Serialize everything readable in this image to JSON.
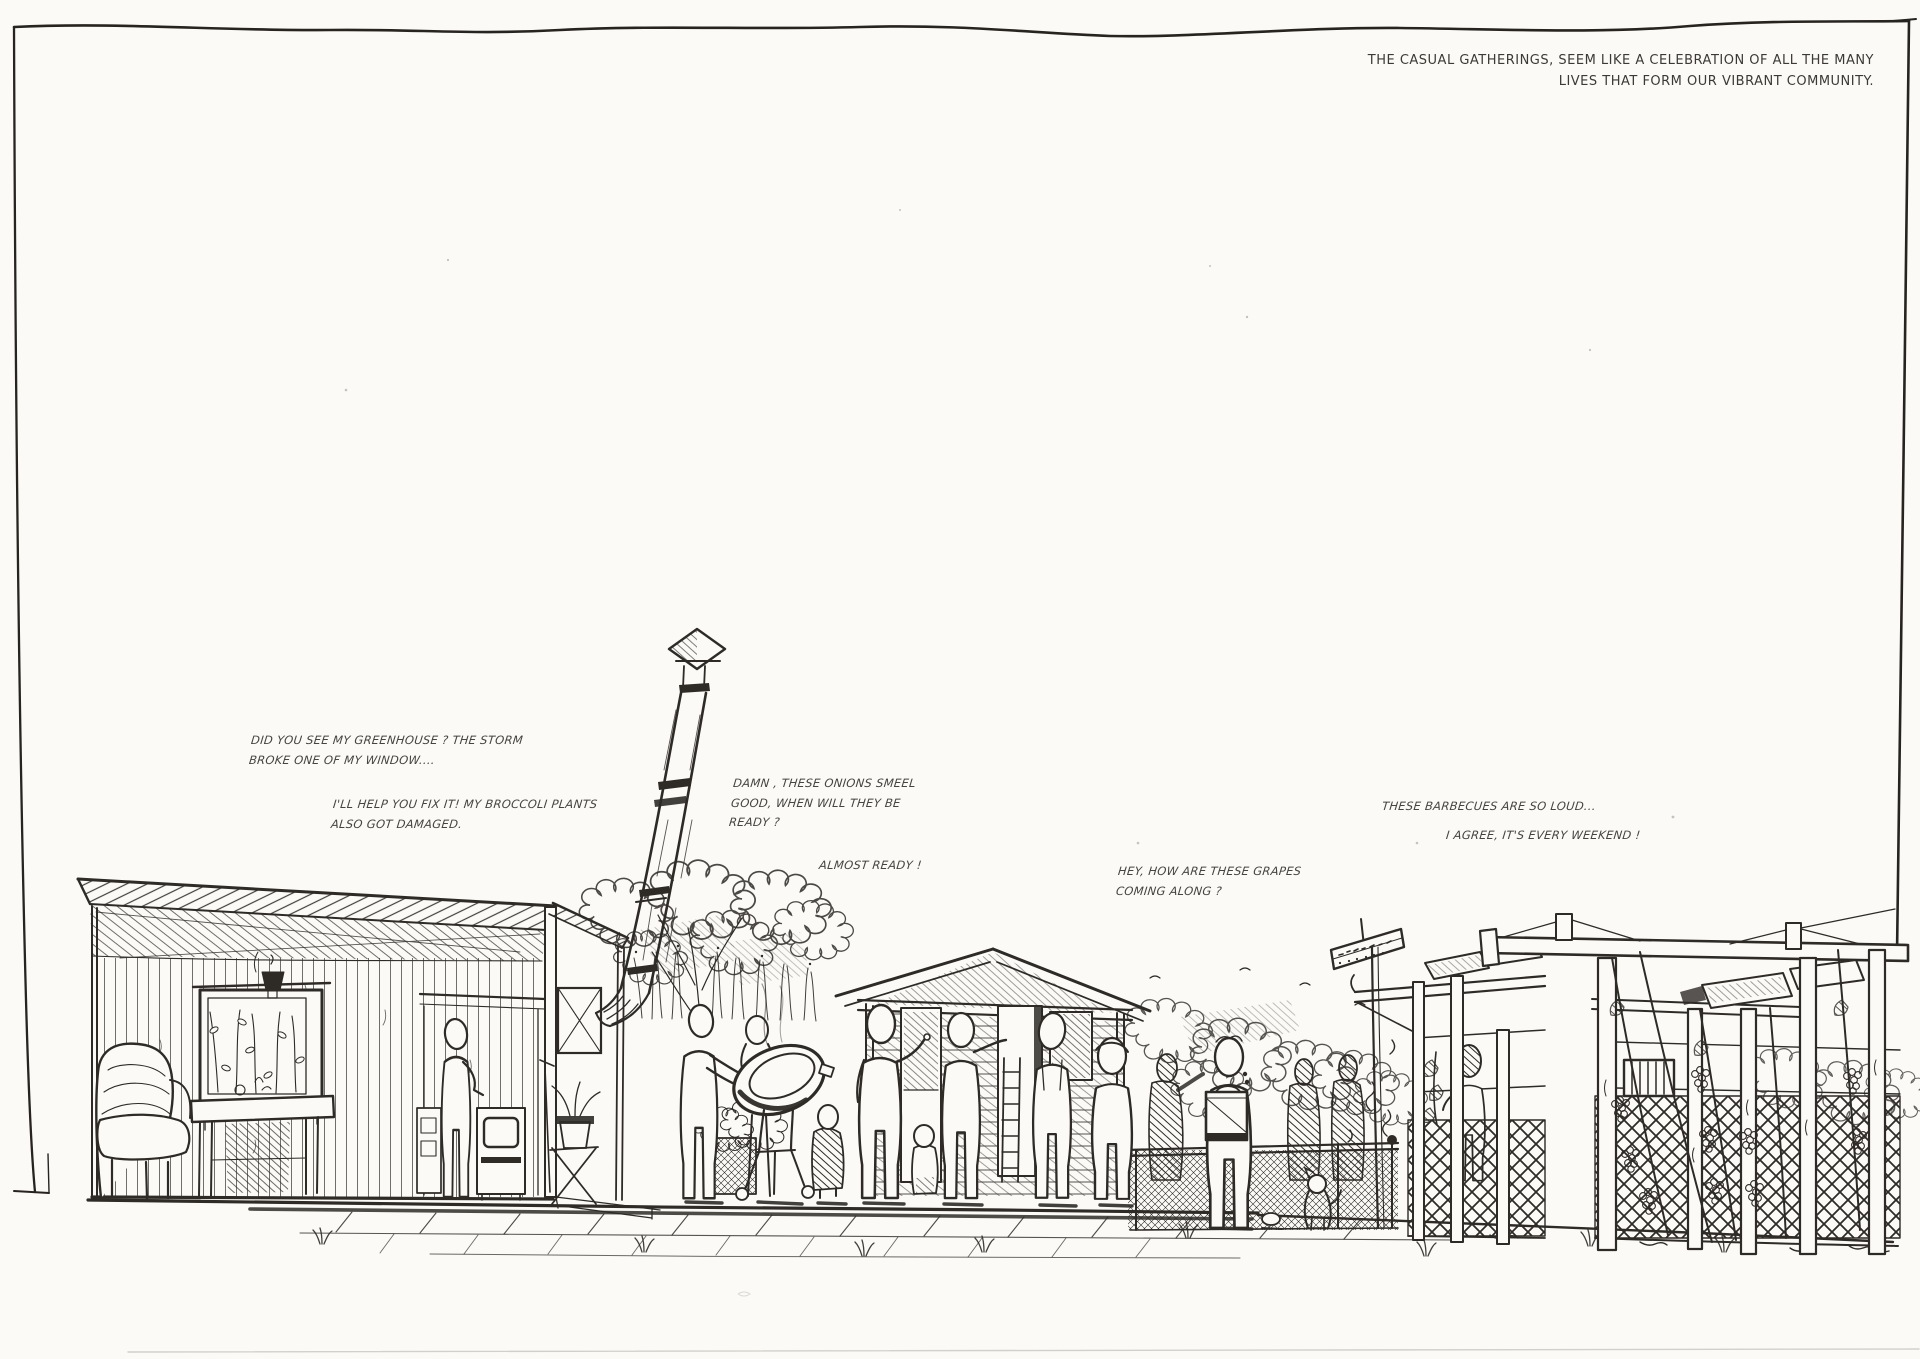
{
  "page": {
    "background": "#fbfaf7",
    "ink": "#2e2b27",
    "caption_color": "#3d3a35",
    "speech_color": "#474440"
  },
  "caption": {
    "line1": "THE CASUAL GATHERINGS, SEEM LIKE A CELEBRATION OF ALL THE MANY",
    "line2": "LIVES THAT FORM OUR VIBRANT COMMUNITY."
  },
  "speech_bubbles": [
    {
      "id": "greenhouse",
      "lines": [
        "DID YOU SEE MY GREENHOUSE ? THE STORM",
        "BROKE ONE OF MY WINDOW...."
      ]
    },
    {
      "id": "fix-it",
      "lines": [
        "I'LL HELP YOU FIX IT! MY BROCCOLI PLANTS",
        "ALSO GOT DAMAGED."
      ]
    },
    {
      "id": "onions",
      "lines": [
        "DAMN , THESE ONIONS SMEEL",
        "GOOD, WHEN WILL THEY BE",
        "READY ?"
      ]
    },
    {
      "id": "almost-ready",
      "lines": [
        "ALMOST READY !"
      ]
    },
    {
      "id": "grapes",
      "lines": [
        "HEY, HOW ARE THESE GRAPES",
        "COMING ALONG ?"
      ]
    },
    {
      "id": "barbecues",
      "lines": [
        "THESE BARBECUES ARE SO LOUD..."
      ]
    },
    {
      "id": "weekend",
      "lines": [
        "I AGREE, IT'S EVERY WEEKEND !"
      ]
    }
  ],
  "scene": {
    "description": "hand-drawn ink sketch of a community garden gathering, sectional elevation",
    "elements": [
      "sketch-frame",
      "garden-shed-section",
      "armchair",
      "table",
      "hanging-lantern",
      "glass-door-plants",
      "standing-figure",
      "wood-stove",
      "potted-plant",
      "lean-to-roof",
      "chimney-flue",
      "tree-and-grass",
      "barbecue-kettle",
      "gathering-figures",
      "child-figures",
      "gable-shed",
      "ladder",
      "mesh-fence",
      "crate-carrier-figure",
      "dog",
      "ball",
      "direction-sign",
      "pergola-left",
      "pergola-right",
      "lattice-trellis",
      "grape-vines",
      "ground-paving"
    ]
  }
}
